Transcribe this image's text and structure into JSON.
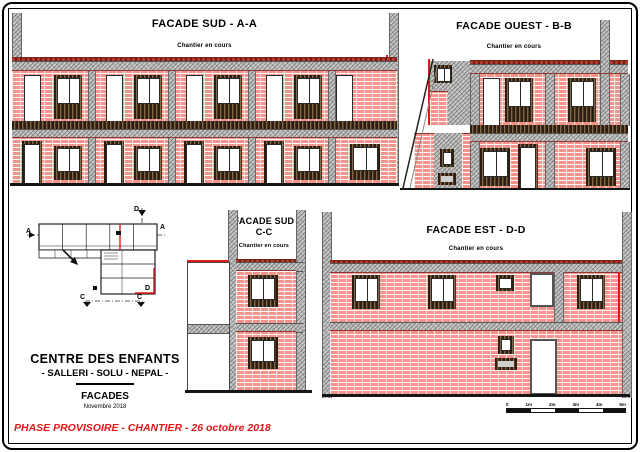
{
  "sheet": {
    "facades": {
      "aa": {
        "title": "FACADE SUD - A-A",
        "subtitle": "Chantier en cours"
      },
      "bb": {
        "title": "FACADE OUEST - B-B",
        "subtitle": "Chantier en cours"
      },
      "cc": {
        "title1": "FACADE SUD",
        "title2": "C-C",
        "subtitle": "Chantier en cours"
      },
      "dd": {
        "title": "FACADE EST - D-D",
        "subtitle": "Chantier en cours"
      }
    },
    "plan": {
      "markers": {
        "a_left": "A",
        "a_right": "A",
        "c_left": "C",
        "c_right": "C",
        "d_top": "D",
        "d_bottom": "D"
      }
    },
    "title_block": {
      "project": "CENTRE DES ENFANTS",
      "location": "- SALLERI - SOLU - NEPAL -",
      "sheet_name": "FACADES",
      "date": "Novembre 2018"
    },
    "phase_note": "PHASE PROVISOIRE - CHANTIER - 26 octobre 2018",
    "scale_bar": {
      "labels": [
        "0",
        "1m",
        "2m",
        "3m",
        "4m",
        "5m"
      ]
    },
    "colors": {
      "brick": "#f2938c",
      "concrete": "#c9c9c9",
      "dark_band": "#50381f",
      "accent_red": "#e01818"
    }
  }
}
